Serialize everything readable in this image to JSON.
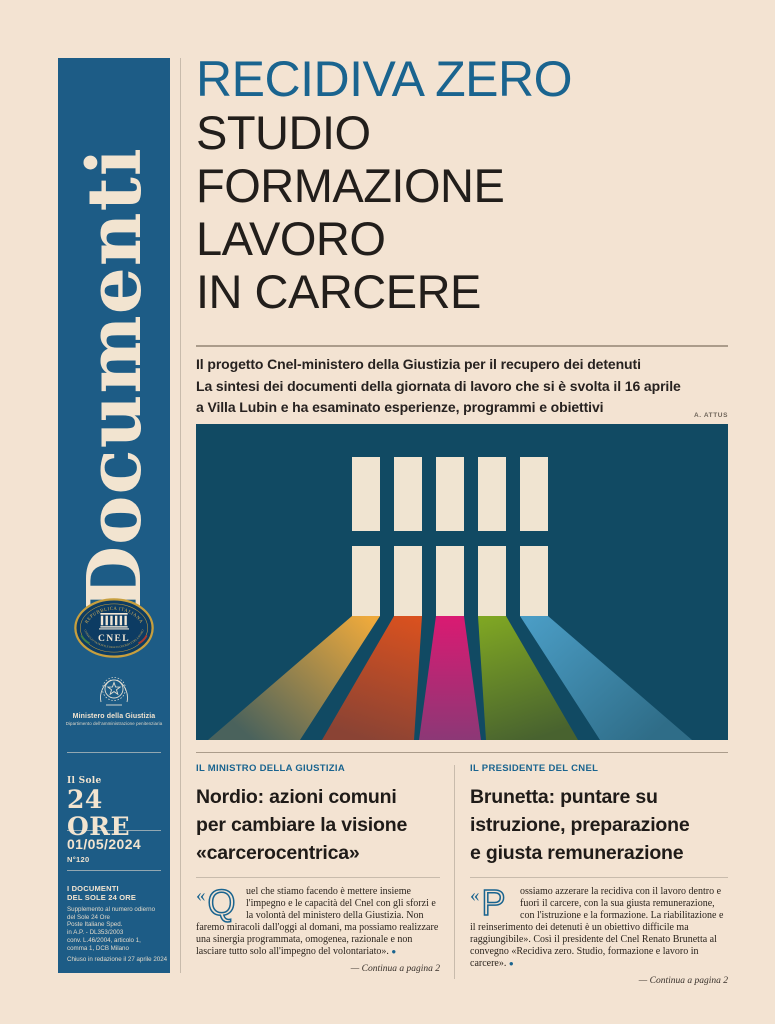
{
  "colors": {
    "cream": "#f3e3d2",
    "cream2": "#f0e4d1",
    "blue": "#1d5c86",
    "accent": "#1a648f",
    "ink": "#221e1b",
    "body-ink": "#2b241d",
    "rule": "#ab9c8b",
    "rule-light": "#c8bbac",
    "imgbg": "#114a63",
    "credit": "#6e6459",
    "gold": "#dcb459",
    "beam-amber": "#eda93c",
    "beam-amber-end": "#4a625c",
    "beam-red": "#d9511f",
    "beam-red-end": "#8a4334",
    "beam-magenta": "#da1a72",
    "beam-magenta-end": "#8c3876",
    "beam-green": "#7fa623",
    "beam-green-end": "#48622f",
    "beam-blue": "#4a9cc4",
    "beam-blue-end": "#2f6d88"
  },
  "sidebar": {
    "masthead": "Documenti",
    "cnel": {
      "top_arc": "REPUBBLICA ITALIANA",
      "name": "CNEL",
      "bottom_arc": "CONSIGLIO NAZIONALE DELL'ECONOMIA E DEL LAVORO"
    },
    "ministry": {
      "name": "Ministero della Giustizia",
      "dept": "Dipartimento dell'amministrazione penitenziaria"
    },
    "sole_small": "Il Sole",
    "sole_big": "24 ORE",
    "date": "01/05/2024",
    "issue_no": "N°120",
    "supplement_line1": "I DOCUMENTI",
    "supplement_line2": "DEL SOLE 24 ORE",
    "imprint_lines": [
      "Supplemento al numero odierno",
      "del Sole 24 Ore",
      "Poste Italiane Sped.",
      "in A.P. - DL353/2003",
      "conv. L.46/2004, articolo 1,",
      "comma 1, DCB Milano"
    ],
    "closing_note": "Chiuso in redazione il 27 aprile 2024"
  },
  "header": {
    "kicker": "RECIDIVA ZERO",
    "title_lines": [
      "STUDIO",
      "FORMAZIONE",
      "LAVORO",
      "IN CARCERE"
    ]
  },
  "standfirst": {
    "lines": [
      "Il progetto Cnel-ministero della Giustizia per il recupero dei detenuti",
      "La sintesi dei documenti della giornata di lavoro che si è svolta il 16 aprile",
      "a Villa Lubin e ha esaminato esperienze, programmi e obiettivi"
    ]
  },
  "photo_credit": "A. ATTUS",
  "articles": [
    {
      "kicker": "IL MINISTRO DELLA GIUSTIZIA",
      "headline_lines": [
        "Nordio: azioni comuni",
        "per cambiare la visione",
        "«carcerocentrica»"
      ],
      "quote_mark": "«",
      "initial": "Q",
      "body": "uel che stiamo facendo è mettere insieme l'impegno e le capacità del Cnel con gli sforzi e la volontà del ministero della Giustizia. Non faremo miracoli dall'oggi al domani, ma possiamo realizzare una sinergia programmata, omogenea, razionale e non lasciare tutto solo all'impegno del volontariato».",
      "end_mark": "●",
      "continua": "— Continua a pagina 2"
    },
    {
      "kicker": "IL PRESIDENTE DEL CNEL",
      "headline_lines": [
        "Brunetta: puntare su",
        "istruzione, preparazione",
        "e giusta remunerazione"
      ],
      "quote_mark": "«",
      "initial": "P",
      "body": "ossiamo azzerare la recidiva con il lavoro dentro e fuori il carcere, con la sua giusta remunerazione, con l'istruzione e la formazione. La riabilitazione e il reinserimento dei detenuti è un obiettivo difficile ma raggiungibile». Così il presidente del Cnel Renato Brunetta al convegno «Recidiva zero. Studio, formazione e lavoro in carcere».",
      "end_mark": "●",
      "continua": "— Continua a pagina 2"
    }
  ]
}
